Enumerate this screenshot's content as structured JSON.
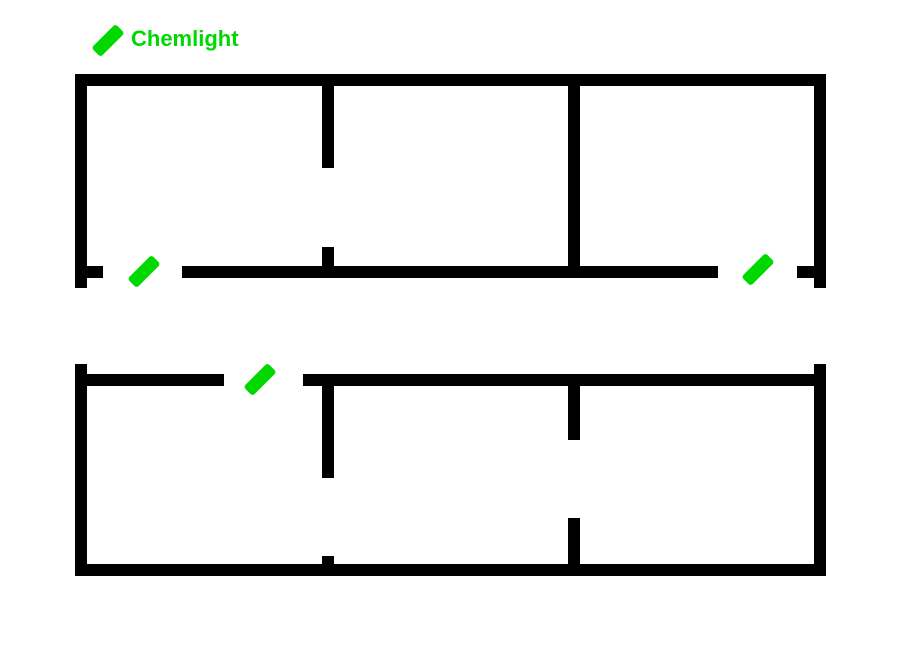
{
  "legend": {
    "label": "Chemlight",
    "icon": {
      "cx": 108,
      "cy": 40,
      "length": 34,
      "width": 13,
      "rotation_deg": -45
    }
  },
  "colors": {
    "background": "#ffffff",
    "wall": "#000000",
    "chemlight": "#00d800",
    "legend_text": "#00d800"
  },
  "floorplan": {
    "canvas": {
      "width": 900,
      "height": 650
    },
    "wall_thickness": 12,
    "buildings": [
      {
        "id": "building-top",
        "walls": [
          {
            "part": "top-wall",
            "x": 75,
            "y": 74,
            "w": 751,
            "h": 12
          },
          {
            "part": "left-wall",
            "x": 75,
            "y": 74,
            "w": 12,
            "h": 214
          },
          {
            "part": "right-wall",
            "x": 814,
            "y": 74,
            "w": 12,
            "h": 214
          },
          {
            "part": "bottom-wall-left-stub",
            "x": 87,
            "y": 266,
            "w": 16,
            "h": 12
          },
          {
            "part": "bottom-wall-main",
            "x": 182,
            "y": 266,
            "w": 536,
            "h": 12
          },
          {
            "part": "bottom-wall-right-stub",
            "x": 797,
            "y": 266,
            "w": 17,
            "h": 12
          },
          {
            "part": "interior-wall-1-upper",
            "x": 322,
            "y": 86,
            "w": 12,
            "h": 82
          },
          {
            "part": "interior-wall-1-lower",
            "x": 322,
            "y": 247,
            "w": 12,
            "h": 19
          },
          {
            "part": "interior-wall-2",
            "x": 568,
            "y": 86,
            "w": 12,
            "h": 180
          }
        ],
        "doors": [
          {
            "side": "bottom",
            "x": 103,
            "y": 266,
            "w": 79
          },
          {
            "side": "bottom",
            "x": 718,
            "y": 266,
            "w": 79
          }
        ]
      },
      {
        "id": "building-bottom",
        "walls": [
          {
            "part": "left-wall",
            "x": 75,
            "y": 364,
            "w": 12,
            "h": 212
          },
          {
            "part": "right-wall",
            "x": 814,
            "y": 364,
            "w": 12,
            "h": 212
          },
          {
            "part": "top-wall-left",
            "x": 87,
            "y": 374,
            "w": 137,
            "h": 12
          },
          {
            "part": "top-wall-main",
            "x": 303,
            "y": 374,
            "w": 523,
            "h": 12
          },
          {
            "part": "bottom-wall",
            "x": 75,
            "y": 564,
            "w": 751,
            "h": 12
          },
          {
            "part": "interior-wall-1-upper",
            "x": 322,
            "y": 386,
            "w": 12,
            "h": 92
          },
          {
            "part": "interior-wall-1-lower",
            "x": 322,
            "y": 556,
            "w": 12,
            "h": 8
          },
          {
            "part": "interior-wall-2-upper",
            "x": 568,
            "y": 386,
            "w": 12,
            "h": 54
          },
          {
            "part": "interior-wall-2-lower",
            "x": 568,
            "y": 518,
            "w": 12,
            "h": 46
          }
        ],
        "doors": [
          {
            "side": "top",
            "x": 224,
            "y": 374,
            "w": 79
          }
        ]
      }
    ],
    "chemlights": [
      {
        "cx": 144,
        "cy": 271,
        "length": 34,
        "width": 13,
        "rotation_deg": -45
      },
      {
        "cx": 758,
        "cy": 269,
        "length": 34,
        "width": 13,
        "rotation_deg": -45
      },
      {
        "cx": 260,
        "cy": 379,
        "length": 34,
        "width": 13,
        "rotation_deg": -45
      }
    ]
  }
}
